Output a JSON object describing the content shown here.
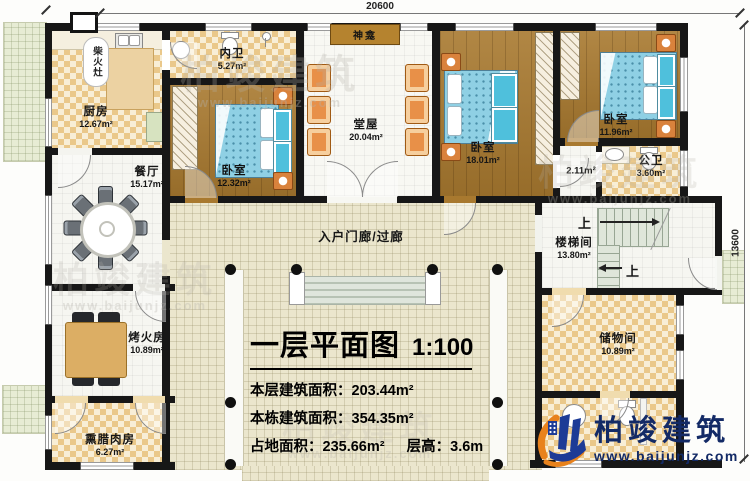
{
  "dimensions": {
    "width": "20600",
    "height": "13600"
  },
  "watermark": {
    "text": "柏竣建筑",
    "url": "www.baijunjz.com"
  },
  "logo": {
    "name": "柏竣建筑",
    "url": "www.baijunjz.com"
  },
  "title_block": {
    "title": "一层平面图",
    "scale": "1:100",
    "floor_area_label": "本层建筑面积：",
    "floor_area_value": "203.44m²",
    "building_area_label": "本栋建筑面积：",
    "building_area_value": "354.35m²",
    "footprint_label": "占地面积：",
    "footprint_value": "235.66m²",
    "story_height_label": "层高：",
    "story_height_value": "3.6m"
  },
  "rooms": {
    "kitchen": {
      "name": "厨房",
      "area": "12.67m²"
    },
    "wood_stove": {
      "name": "柴火灶"
    },
    "inner_bath": {
      "name": "内卫",
      "area": "5.27m²"
    },
    "shrine": {
      "name": "神龛"
    },
    "hall": {
      "name": "堂屋",
      "area": "20.04m²"
    },
    "bedroom_sw": {
      "name": "卧室",
      "area": "12.32m²"
    },
    "bedroom_mid": {
      "name": "卧室",
      "area": "18.01m²"
    },
    "bedroom_ne": {
      "name": "卧室",
      "area": "11.96m²"
    },
    "vestibule": {
      "area": "2.11m²"
    },
    "public_bath": {
      "name": "公卫",
      "area": "3.60m²"
    },
    "stairwell": {
      "name": "楼梯间",
      "area": "13.80m²",
      "up": "上"
    },
    "dining": {
      "name": "餐厅",
      "area": "15.17m²"
    },
    "porch": {
      "name": "入户门廊/过廊"
    },
    "fire_room": {
      "name": "烤火房",
      "area": "10.89m²"
    },
    "bacon_room": {
      "name": "熏腊肉房",
      "area": "6.27m²"
    },
    "storage": {
      "name": "储物间",
      "area": "10.89m²"
    }
  }
}
